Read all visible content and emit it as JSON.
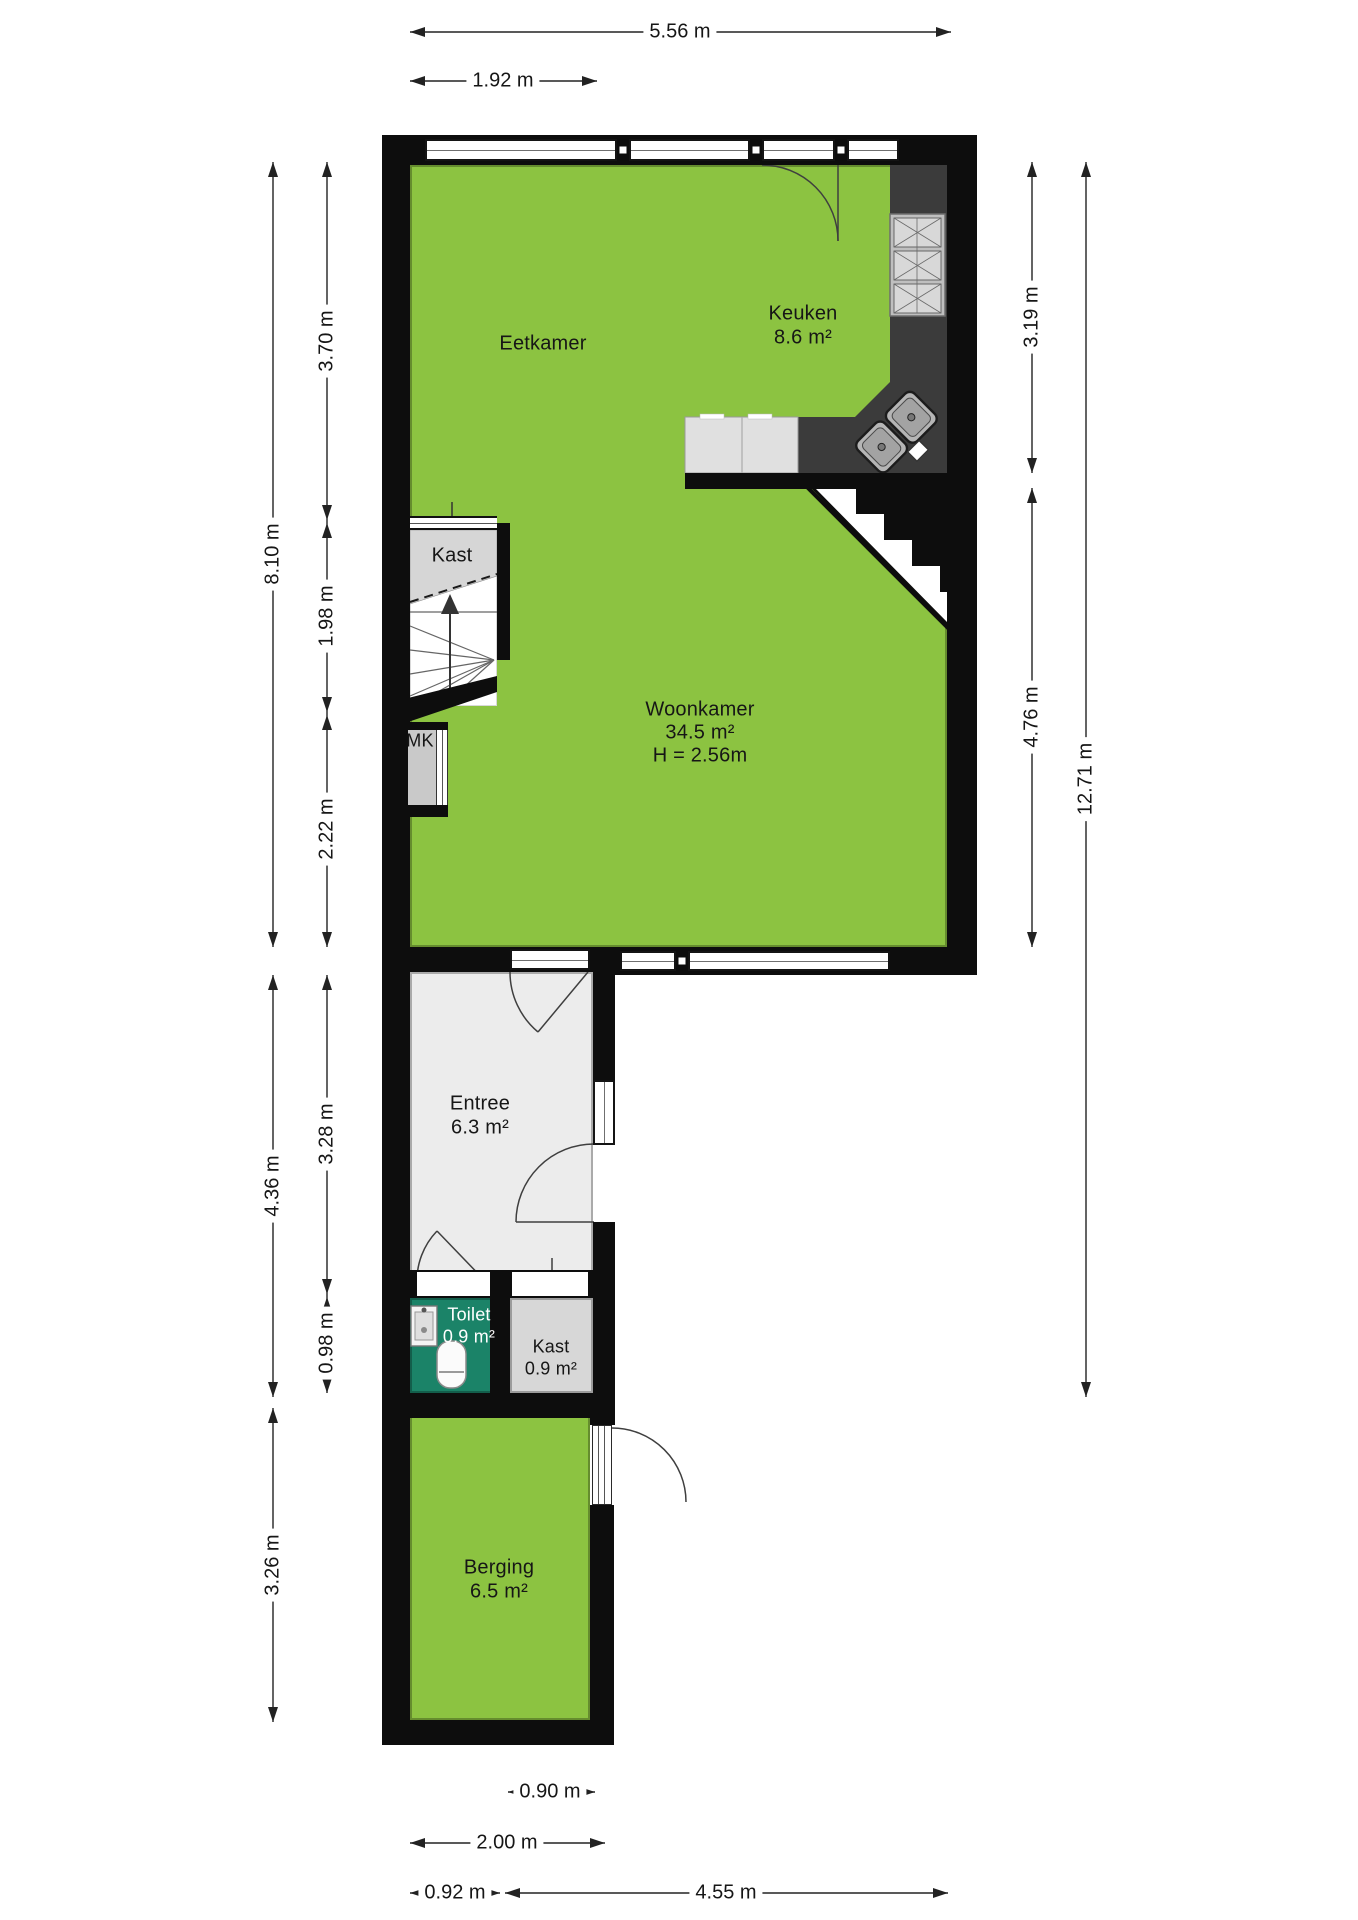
{
  "plan": {
    "rooms": {
      "eetkamer": {
        "name": "Eetkamer"
      },
      "keuken": {
        "name": "Keuken",
        "area": "8.6 m²"
      },
      "woonkamer": {
        "name": "Woonkamer",
        "area": "34.5 m²",
        "height": "H = 2.56m"
      },
      "kast_boven": {
        "name": "Kast"
      },
      "mk": {
        "name": "MK"
      },
      "entree": {
        "name": "Entree",
        "area": "6.3 m²"
      },
      "toilet": {
        "name": "Toilet",
        "area": "0.9 m²"
      },
      "kast_onder": {
        "name": "Kast",
        "area": "0.9 m²"
      },
      "berging": {
        "name": "Berging",
        "area": "6.5 m²"
      }
    },
    "dimensions": {
      "top": [
        {
          "label": "5.56 m"
        },
        {
          "label": "1.92 m"
        }
      ],
      "left": [
        {
          "label": "8.10 m"
        },
        {
          "label": "3.70 m"
        },
        {
          "label": "1.98 m"
        },
        {
          "label": "2.22 m"
        },
        {
          "label": "4.36 m"
        },
        {
          "label": "3.28 m"
        },
        {
          "label": "0.98 m"
        },
        {
          "label": "3.26 m"
        }
      ],
      "right": [
        {
          "label": "3.19 m"
        },
        {
          "label": "4.76 m"
        },
        {
          "label": "12.71 m"
        }
      ],
      "bottom": [
        {
          "label": "0.90 m"
        },
        {
          "label": "2.00 m"
        },
        {
          "label": "0.92 m"
        },
        {
          "label": "4.55 m"
        }
      ]
    },
    "colors": {
      "floor_green": "#8CC341",
      "floor_light": "#ECECEC",
      "closet_gray": "#D7D7D7",
      "toilet_green": "#1B8368",
      "wall_black": "#0D0D0D",
      "counter_dark": "#3B3B3B",
      "counter_light": "#E0E0E0"
    }
  }
}
